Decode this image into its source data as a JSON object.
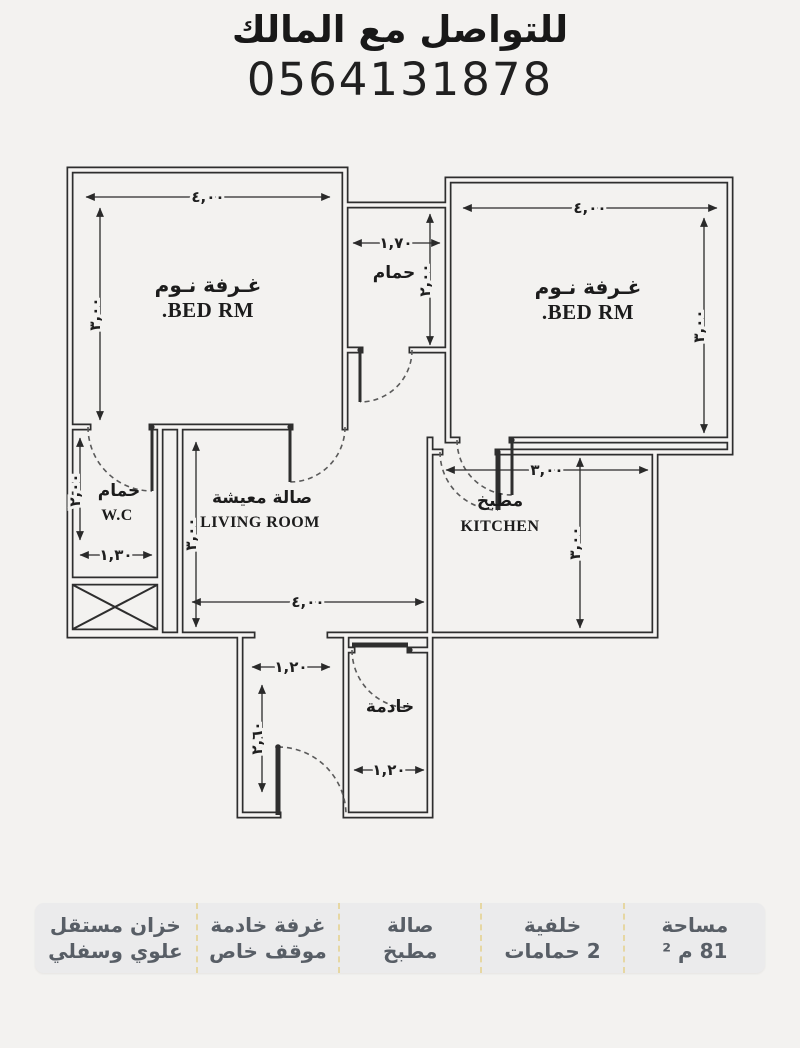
{
  "header": {
    "contact_line": "للتواصل مع المالك",
    "phone": "0564131878"
  },
  "plan": {
    "rooms": {
      "bedroom_left_ar": "غـرفة نـوم",
      "bedroom_left_en": "BED RM.",
      "bedroom_right_ar": "غـرفة نـوم",
      "bedroom_right_en": "BED RM.",
      "bathroom_ar": "حمام",
      "wc_ar": "حمام",
      "wc_en": "W.C",
      "living_ar": "صالة معيشة",
      "living_en": "LIVING ROOM",
      "kitchen_ar": "مطبخ",
      "kitchen_en": "KITCHEN",
      "maid_ar": "خادمة"
    },
    "dims": {
      "bed_left_w": "٤,٠٠",
      "bed_left_h": "٣,٠٠",
      "bed_right_w": "٤,٠٠",
      "bed_right_h": "٣,٠٠",
      "bath_w": "١,٧٠",
      "bath_h": "٢,٠٠",
      "wc_w": "١,٣٠",
      "wc_h": "٢,٠٠",
      "living_w": "٤,٠٠",
      "living_h": "٣,٠٠",
      "kitchen_w": "٣,٠٠",
      "kitchen_h": "٣,٠٠",
      "hall_w": "١,٢٠",
      "hall_h": "٢,٦٠",
      "maid_w": "١,٢٠"
    }
  },
  "features": [
    {
      "line1": "مساحة",
      "line2": "81 م ²"
    },
    {
      "line1": "خلفية",
      "line2": "2 حمامات"
    },
    {
      "line1": "صالة",
      "line2": "مطبخ"
    },
    {
      "line1": "غرفة خادمة",
      "line2": "موقف خاص"
    },
    {
      "line1": "خزان مستقل",
      "line2": "علوي وسفلي"
    }
  ],
  "colors": {
    "ink": "#2e2e2e",
    "paper": "#f3f2f0",
    "strip_bg": "#ebebec",
    "strip_text": "#585e66",
    "separator": "#e6d7a3"
  }
}
